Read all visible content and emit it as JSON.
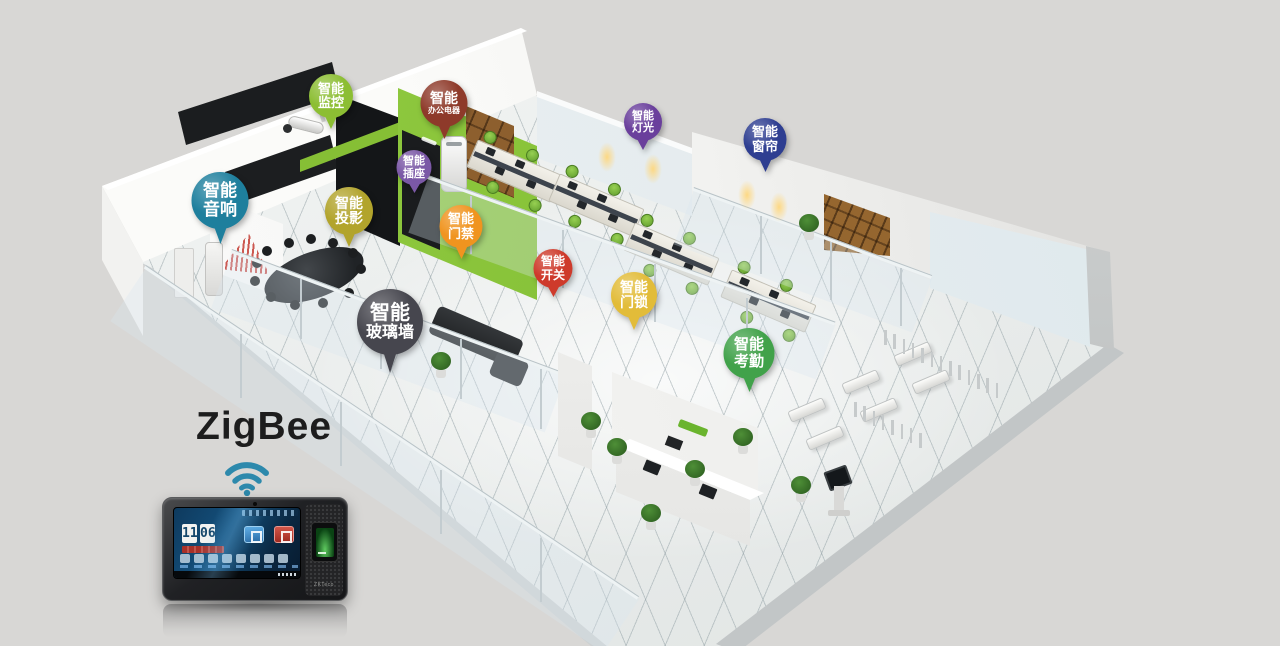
{
  "scene": {
    "title": "ZigBee",
    "title_color": "#1d1d1d",
    "background": "#d8d7d5",
    "palette": {
      "accent_wall_green": "#86bf35",
      "wifi_blue": "#2d89ac",
      "floor": "#eef0ef"
    }
  },
  "icons": [
    "wifi-signal-icon",
    "security-camera-icon",
    "fingerprint-sensor-icon"
  ],
  "callouts": [
    {
      "id": "monitoring",
      "line1": "智能",
      "line2": "监控",
      "color": "#8cbe33",
      "x": 331,
      "y": 129,
      "d": 44
    },
    {
      "id": "office-appliance",
      "line1": "智能",
      "line2": "办公电器",
      "color": "#8e3a2a",
      "x": 444,
      "y": 139,
      "d": 47
    },
    {
      "id": "socket",
      "line1": "智能",
      "line2": "插座",
      "color": "#7b58a6",
      "x": 414,
      "y": 193,
      "d": 35
    },
    {
      "id": "lighting",
      "line1": "智能",
      "line2": "灯光",
      "color": "#6a3f9c",
      "x": 643,
      "y": 150,
      "d": 38
    },
    {
      "id": "curtain",
      "line1": "智能",
      "line2": "窗帘",
      "color": "#2e3e91",
      "x": 765,
      "y": 172,
      "d": 43
    },
    {
      "id": "audio",
      "line1": "智能",
      "line2": "音响",
      "color": "#1e7f9d",
      "x": 220,
      "y": 244,
      "d": 57
    },
    {
      "id": "projection",
      "line1": "智能",
      "line2": "投影",
      "color": "#b2a42c",
      "x": 349,
      "y": 247,
      "d": 48
    },
    {
      "id": "access-control",
      "line1": "智能",
      "line2": "门禁",
      "color": "#f0941f",
      "x": 461,
      "y": 259,
      "d": 43
    },
    {
      "id": "switch",
      "line1": "智能",
      "line2": "开关",
      "color": "#ce3a2b",
      "x": 553,
      "y": 297,
      "d": 39
    },
    {
      "id": "door-lock",
      "line1": "智能",
      "line2": "门锁",
      "color": "#e2bc39",
      "x": 634,
      "y": 330,
      "d": 46
    },
    {
      "id": "glass-wall",
      "line1": "智能",
      "line2": "玻璃墙",
      "color": "#46464e",
      "x": 390,
      "y": 373,
      "d": 66
    },
    {
      "id": "attendance",
      "line1": "智能",
      "line2": "考勤",
      "color": "#41a24a",
      "x": 749,
      "y": 392,
      "d": 51
    }
  ],
  "device": {
    "brand": "ZKTeco",
    "screen": {
      "clock_hour": "11",
      "clock_min": "06"
    }
  }
}
